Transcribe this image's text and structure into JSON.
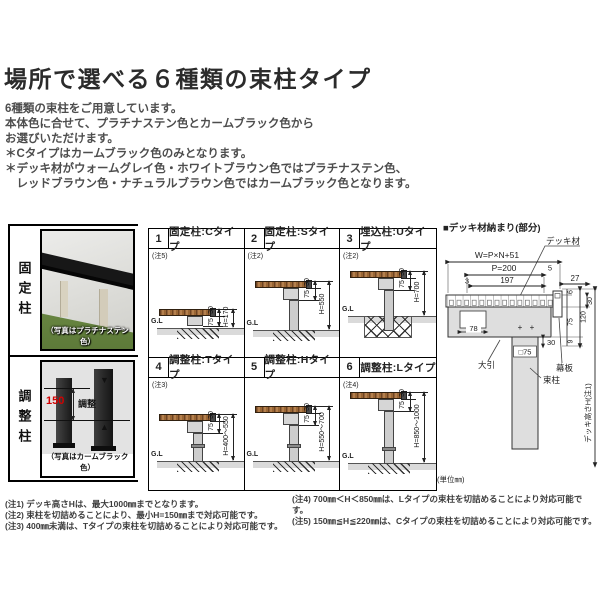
{
  "header": {
    "title": "場所で選べる６種類の束柱タイプ"
  },
  "intro": {
    "lines": [
      "6種類の束柱をご用意しています。",
      "本体色に合せて、プラチナステン色とカームブラック色から",
      "お選びいただけます。",
      "＊Cタイプはカームブラック色のみとなります。",
      "＊デッキ材がウォームグレイ色・ホワイトブラウン色ではプラチナステン色、",
      "　レッドブラウン色・ナチュラルブラウン色ではカームブラック色となります。"
    ]
  },
  "photo_panels": {
    "fixed": {
      "side_label": "固定柱",
      "caption": "（写真はプラチナステン色）"
    },
    "adjust": {
      "side_label": "調整柱",
      "caption": "（写真はカームブラック色）",
      "dim_value": "150",
      "dim_label": "調整",
      "arrow_down": "▼",
      "arrow_up": "▲"
    }
  },
  "cells": [
    {
      "num": "1",
      "title": "固定柱:Cタイプ",
      "note": "(注5)",
      "dim_top": "30",
      "dim_mid": "75",
      "dim_h": "H=170",
      "gl": "G.L"
    },
    {
      "num": "2",
      "title": "固定柱:Sタイプ",
      "note": "(注2)",
      "dim_top": "30",
      "dim_mid": "75",
      "dim_h": "H=550",
      "gl": "G.L"
    },
    {
      "num": "3",
      "title": "埋込柱:Uタイプ",
      "note": "(注2)",
      "dim_top": "30",
      "dim_mid": "75",
      "dim_h": "H=700",
      "gl": "G.L"
    },
    {
      "num": "4",
      "title": "調整柱:Tタイプ",
      "note": "(注3)",
      "dim_top": "30",
      "dim_mid": "75",
      "dim_h": "H=400〜550",
      "gl": "G.L"
    },
    {
      "num": "5",
      "title": "調整柱:Hタイプ",
      "note": "",
      "dim_top": "30",
      "dim_mid": "75",
      "dim_h": "H=550〜700",
      "gl": "G.L"
    },
    {
      "num": "6",
      "title": "調整柱:Lタイプ",
      "note": "(注4)",
      "dim_top": "30",
      "dim_mid": "75",
      "dim_h": "H=850〜1000",
      "gl": "G.L"
    }
  ],
  "detail": {
    "title": "■デッキ材納まり(部分)",
    "deck_label": "デッキ材",
    "dim_w": "W=P×N+51",
    "dim_p": "P=200",
    "dim_5": "5",
    "dim_3": "3",
    "dim_197": "197",
    "dim_27": "27",
    "dim_30_top": "30",
    "dim_6": "6",
    "dim_120": "120",
    "dim_75": "75",
    "dim_9": "9",
    "dim_78": "78",
    "dim_30_joist": "30",
    "dim_post": "□75",
    "joist_label": "大引",
    "fascia_label": "幕板",
    "post_label": "束柱",
    "height_label": "デッキ高さH(注1)",
    "plus_mark": "+",
    "unit": "(単位㎜)"
  },
  "notes": {
    "left": [
      "(注1) デッキ高さHは、最大1000㎜までとなります。",
      "(注2) 束柱を切詰めることにより、最小H=150㎜まで対応可能です。",
      "(注3) 400㎜未満は、Tタイプの束柱を切詰めることにより対応可能です。"
    ],
    "right": [
      "(注4) 700㎜＜H＜850㎜は、Lタイプの束柱を切詰めることにより対応可能です。",
      "(注5) 150㎜≦H≦220㎜は、Cタイプの束柱を切詰めることにより対応可能です。"
    ]
  },
  "colors": {
    "accent_red": "#d40000",
    "wood": "#b5804d",
    "ground_gray": "#dadada",
    "line_black": "#000000"
  }
}
